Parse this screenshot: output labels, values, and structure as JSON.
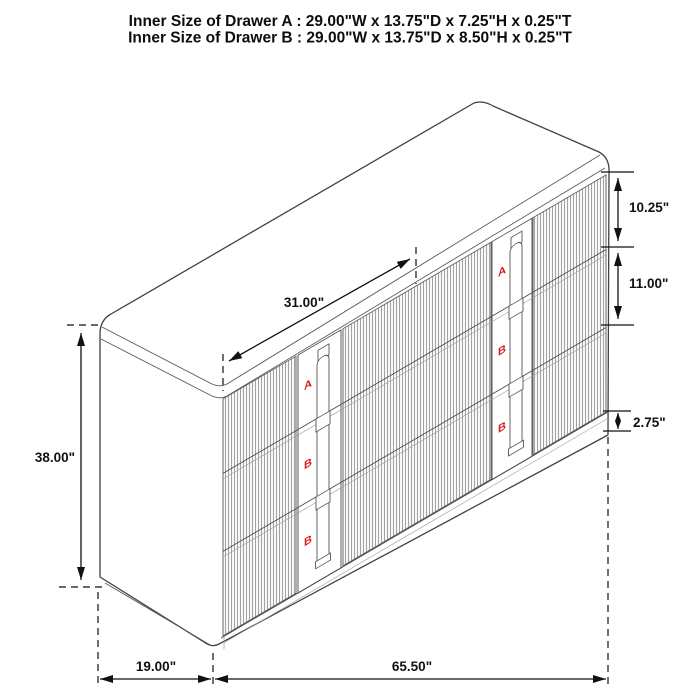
{
  "title": {
    "line1": "Inner Size of Drawer A : 29.00\"W x 13.75\"D x 7.25\"H x 0.25\"T",
    "line2": "Inner Size of Drawer B : 29.00\"W x 13.75\"D x 8.50\"H x 0.25\"T"
  },
  "dimensions": {
    "diagonal_width": "31.00\"",
    "overall_height": "38.00\"",
    "drawer_a_front_height": "10.25\"",
    "drawer_b_front_height": "11.00\"",
    "base_height": "2.75\"",
    "side_depth": "19.00\"",
    "front_width": "65.50\""
  },
  "drawer_labels": {
    "a": "A",
    "b": "B"
  },
  "colors": {
    "outline": "#424242",
    "flute": "#6e6e6e",
    "dimension": "#111111",
    "drawer_label": "#d92020",
    "background": "#ffffff"
  }
}
